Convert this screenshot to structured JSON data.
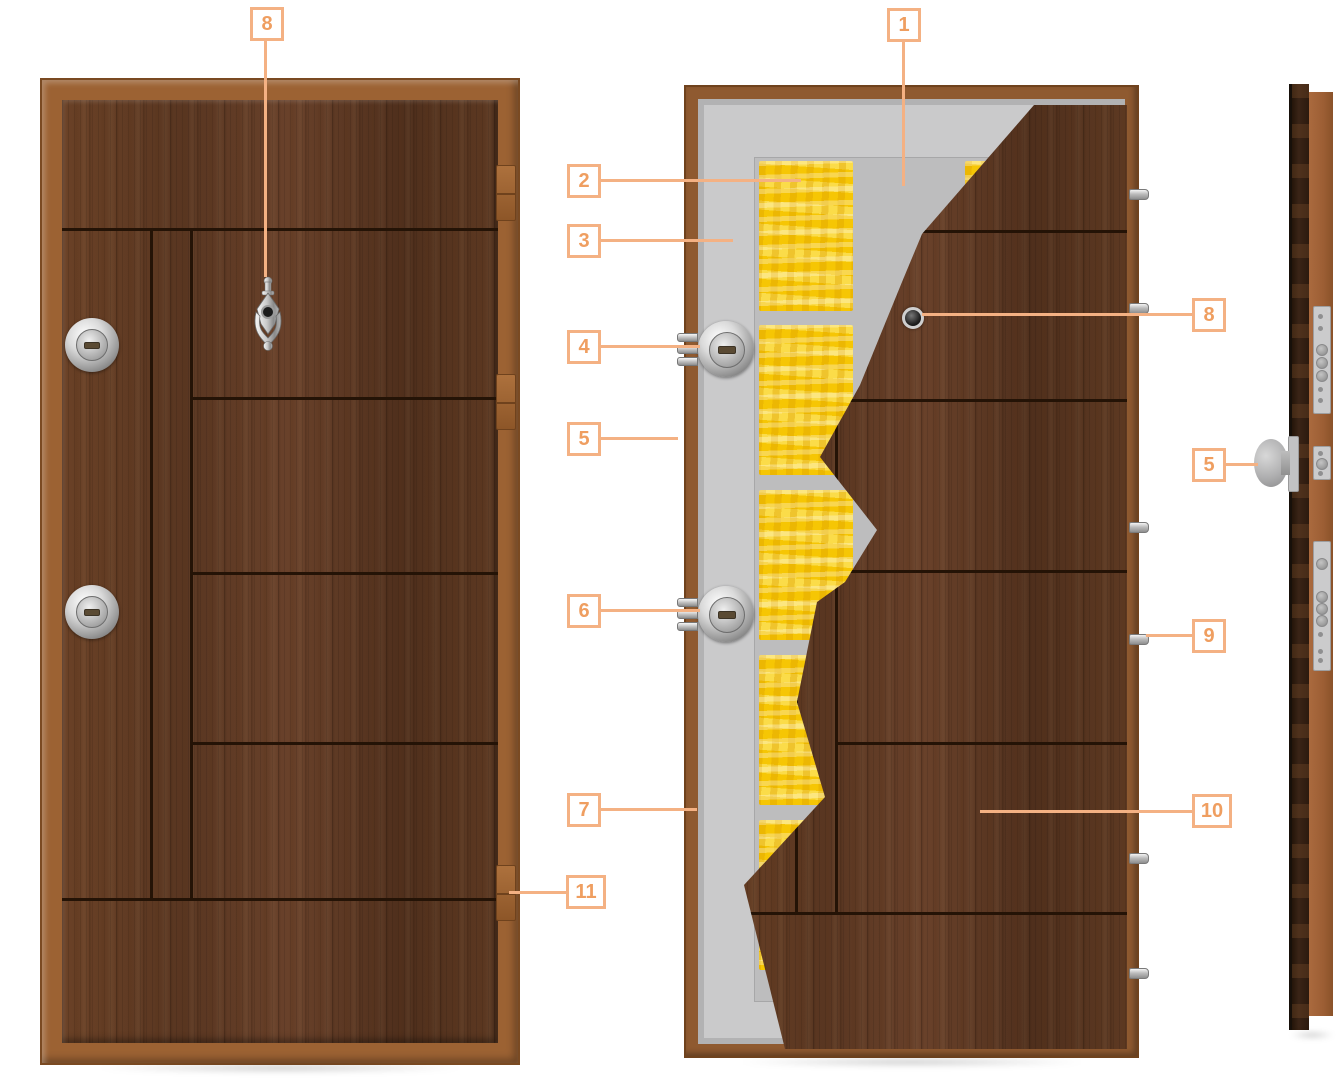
{
  "diagram": {
    "subject": "security-door-construction",
    "views": [
      "front-exterior-door",
      "cutaway-inside-door",
      "side-edge-door"
    ]
  },
  "callouts": [
    {
      "key": "door-knocker",
      "label": "8"
    },
    {
      "key": "steel-sheet",
      "label": "1"
    },
    {
      "key": "mineral-insulation",
      "label": "2"
    },
    {
      "key": "steel-body",
      "label": "3"
    },
    {
      "key": "upper-lock-cylinder",
      "label": "4"
    },
    {
      "key": "door-leaf-edge",
      "label": "5"
    },
    {
      "key": "lower-lock-cylinder",
      "label": "6"
    },
    {
      "key": "door-frame-edge",
      "label": "7"
    },
    {
      "key": "hinge",
      "label": "11"
    },
    {
      "key": "peephole",
      "label": "8"
    },
    {
      "key": "handle-knob",
      "label": "5"
    },
    {
      "key": "security-pin",
      "label": "9"
    },
    {
      "key": "wood-panel",
      "label": "10"
    }
  ],
  "colors": {
    "accent_orange_border": "#f4b183",
    "accent_orange_number": "#ef9e60",
    "insulation_yellow": "#f6c604",
    "steel_grey": "#cacacb",
    "frame_brown": "#9c6233",
    "leaf_wood_brown": "#5d3922",
    "groove_dark": "#241306"
  }
}
